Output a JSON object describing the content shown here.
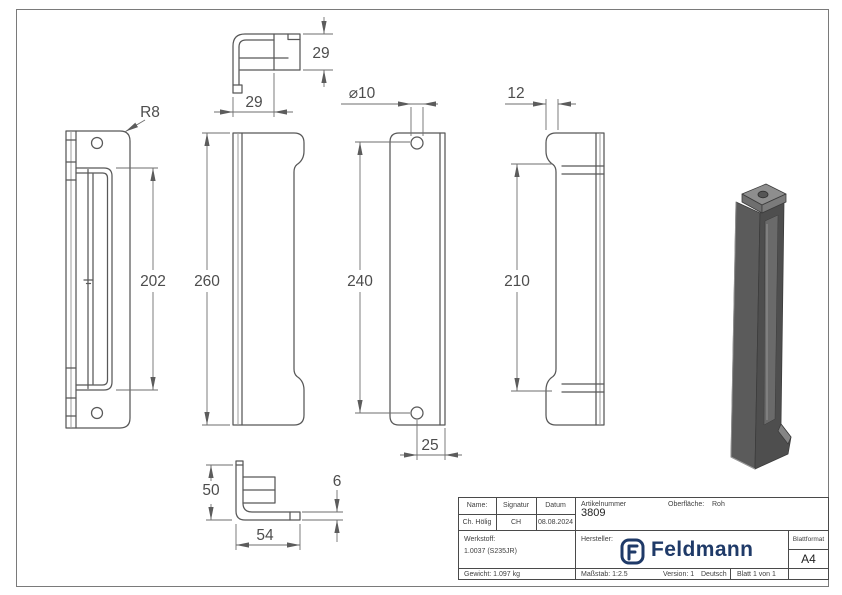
{
  "dims": {
    "top_w": "29",
    "top_h": "29",
    "radius": "R8",
    "slot": "202",
    "height": "260",
    "hole_dia": "⌀10",
    "hole_span": "240",
    "hole_offset": "25",
    "lip": "12",
    "notch": "210",
    "foot_h": "50",
    "foot_w": "54",
    "thickness": "6"
  },
  "title_block": {
    "name_label": "Name:",
    "signature_label": "Signatur",
    "date_label": "Datum",
    "name": "Ch. Hölig",
    "signature": "CH",
    "date": "08.08.2024",
    "article_label": "Artikelnummer",
    "article_number": "3809",
    "surface_label": "Oberfläche:",
    "surface_value": "Roh",
    "material_label": "Werkstoff:",
    "material_value": "1.0037 (S235JR)",
    "manufacturer_label": "Hersteller:",
    "brand_name": "Feldmann",
    "format_label": "Blattformat",
    "format_value": "A4",
    "weight": "Gewicht: 1.097 kg",
    "scale": "Maßstab: 1:2.5",
    "version": "Version: 1",
    "language": "Deutsch",
    "sheet": "Blatt 1 von 1"
  },
  "colors": {
    "brand_blue": "#1f3a68",
    "outline_gray": "#585858",
    "render_body": "#5b5b5b",
    "render_side": "#4e4e4e",
    "render_top": "#8e8e8e"
  }
}
